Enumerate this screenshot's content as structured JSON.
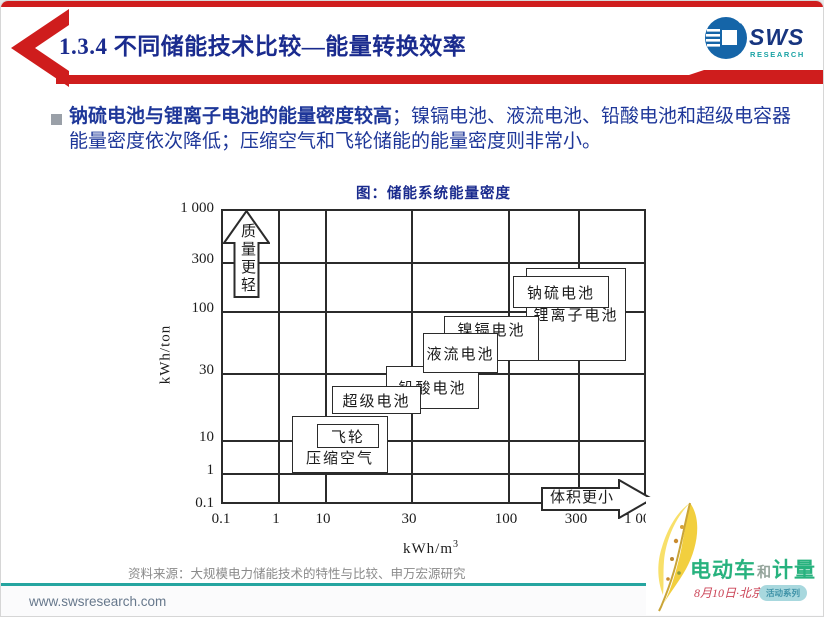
{
  "header": {
    "title": "1.3.4 不同储能技术比较—能量转换效率",
    "logo_text": "SWS",
    "logo_subtext": "RESEARCH"
  },
  "bullet": {
    "bold_text": "钠硫电池与锂离子电池的能量密度较高",
    "regular_text": "；镍镉电池、液流电池、铅酸电池和超级电容器能量密度依次降低；压缩空气和飞轮储能的能量密度则非常小。"
  },
  "figure": {
    "title": "图：储能系统能量密度",
    "ylabel": "kWh/ton",
    "xlabel_base": "kWh/m",
    "xlabel_sup": "3",
    "arrow_up_label": "质量更轻",
    "arrow_right_label": "体积更小"
  },
  "chart_data": {
    "type": "scatter",
    "title": "图：储能系统能量密度",
    "xlabel": "kWh/m³",
    "ylabel": "kWh/ton",
    "x_scale": "log",
    "y_scale": "log",
    "xlim": [
      0.1,
      1000
    ],
    "ylim": [
      0.1,
      1000
    ],
    "grid": true,
    "x_ticks": [
      "0.1",
      "1",
      "10",
      "30",
      "100",
      "300",
      "1 000"
    ],
    "y_ticks": [
      "1 000",
      "300",
      "100",
      "30",
      "10",
      "1",
      "0.1"
    ],
    "annotations": [
      {
        "label": "质量更轻",
        "shape": "block-arrow-up",
        "position": "top-left"
      },
      {
        "label": "体积更小",
        "shape": "block-arrow-right",
        "position": "bottom-right"
      }
    ],
    "boxes": [
      {
        "label": "压缩空气",
        "x_range": [
          2,
          23
        ],
        "y_range": [
          1,
          14
        ]
      },
      {
        "label": "飞轮",
        "x_range": [
          7.5,
          20
        ],
        "y_range": [
          5,
          13
        ]
      },
      {
        "label": "超级电池",
        "x_range": [
          11,
          35
        ],
        "y_range": [
          15,
          24
        ]
      },
      {
        "label": "铅酸电池",
        "x_range": [
          22,
          70
        ],
        "y_range": [
          16,
          31
        ]
      },
      {
        "label": "液流电池",
        "x_range": [
          35,
          97
        ],
        "y_range": [
          30,
          63
        ]
      },
      {
        "label": "镍镉电池",
        "x_range": [
          47,
          165
        ],
        "y_range": [
          36,
          88
        ]
      },
      {
        "label": "钠硫电池",
        "x_range": [
          100,
          530
        ],
        "y_range": [
          100,
          210
        ]
      },
      {
        "label": "锂离子电池",
        "x_range": [
          140,
          700
        ],
        "y_range": [
          36,
          250
        ]
      }
    ]
  },
  "source": {
    "label": "资料来源：大规模电力储能技术的特性与比较、申万宏源研究"
  },
  "footer": {
    "url": "www.swsresearch.com"
  },
  "watermark": {
    "title_part1": "电动车",
    "title_part2": "和",
    "title_part3": "计量",
    "date": "8月10日·北京",
    "badge": "活动系列"
  },
  "colors": {
    "accent_red": "#cf1d1d",
    "title_navy": "#1a2b8e",
    "body_blue": "#1e3799",
    "footer_teal": "#25a5a0",
    "watermark_green": "#27b27e",
    "logo_blue": "#17357f",
    "logo_teal": "#1ba3a5"
  }
}
